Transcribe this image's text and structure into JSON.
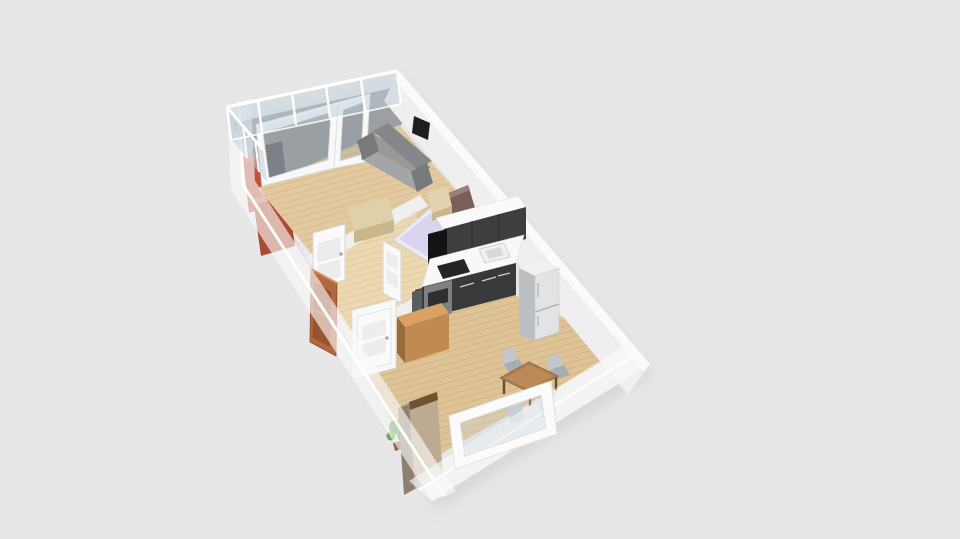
{
  "scene": {
    "kind": "3d-floorplan-render",
    "rooms": [
      {
        "name": "balcony"
      },
      {
        "name": "living-room"
      },
      {
        "name": "hallway"
      },
      {
        "name": "bed-nook"
      },
      {
        "name": "kitchen"
      },
      {
        "name": "dining-area"
      }
    ],
    "objects": [
      {
        "name": "glass-railing"
      },
      {
        "name": "balcony-divider"
      },
      {
        "name": "red-cabinet"
      },
      {
        "name": "window-wall"
      },
      {
        "name": "sofa"
      },
      {
        "name": "tv"
      },
      {
        "name": "sideboard"
      },
      {
        "name": "bed"
      },
      {
        "name": "headboard"
      },
      {
        "name": "nightstand"
      },
      {
        "name": "upper-cabinets"
      },
      {
        "name": "range-hood"
      },
      {
        "name": "cooktop"
      },
      {
        "name": "counter"
      },
      {
        "name": "sink"
      },
      {
        "name": "oven"
      },
      {
        "name": "fridge"
      },
      {
        "name": "interior-door"
      },
      {
        "name": "entry-door"
      },
      {
        "name": "hall-cabinet"
      },
      {
        "name": "dining-table"
      },
      {
        "name": "chair"
      },
      {
        "name": "plant"
      },
      {
        "name": "tall-wardrobe"
      },
      {
        "name": "end-window"
      }
    ]
  },
  "colors": {
    "background": "#e7e7e7",
    "shadow": "#c8c8c8",
    "slab": "#f3f3f3",
    "wall_face": "#efefef",
    "wall_edge": "#fbfbfb",
    "ghost_wall": "rgba(250,250,250,0.62)",
    "glass_rail": "rgba(190,206,216,0.5)",
    "glass_window": "rgba(150,160,166,0.3)",
    "window_glass": "rgba(210,218,224,0.3)",
    "balcony_floor": "#9da0a2",
    "divider": "#70757a",
    "red_cabinet": "#bc5540",
    "red_cabinet_dark": "#aa4a33",
    "red_cabinet_top": "#cf705a",
    "wood_living": "#e3c9a0",
    "wood_hall": "#ecd9b2",
    "wood_dining": "#dec397",
    "p_wall": "#f2f2f2",
    "frame_white": "#f7f8f8",
    "sofa_back": "#85878a",
    "sofa_seat": "#97999b",
    "sofa_front": "#a3a5a7",
    "sofa_arm": "#77797b",
    "tv": "#1e1e20",
    "door_white": "#fafafa",
    "door_panel": "#ededed",
    "entry_door": "#b26743",
    "entry_panel": "#97552f",
    "sideboard": "#e0d0aa",
    "sideboard_front": "#c9b68c",
    "bed_frame": "#eceaf4",
    "bed_mattress": "#dad5ed",
    "pillow": "#f6f5fb",
    "headboard": "#7a5e5a",
    "headboard_top": "#9c7f79",
    "nightstand": "#e2d2ae",
    "cab_upper_top": "#fafafa",
    "cab_dark": "#3c3e40",
    "counter": "#f8f8f8",
    "counter_front": "#37393b",
    "hood": "#141416",
    "cooktop": "#232527",
    "oven": "#7e8183",
    "oven_window": "#2d2f31",
    "end_side": "#5a5d60",
    "sink_rim": "#f0f0f0",
    "sink_basin": "#d7d9da",
    "fridge_top": "#eef0f1",
    "fridge_side": "#bcbfc1",
    "fridge_front": "#e1e3e4",
    "hall_cab_top": "#d9a263",
    "hall_cab_front": "#c08a50",
    "hall_cab_side": "#9a6b3a",
    "table_top": "#b07e4e",
    "table_light": "#bf8d5c",
    "table_leg": "#6e4d2e",
    "chair_seat": "#a6adb3",
    "chair_back": "#c2c8cd",
    "wardrobe_front": "#bcab92",
    "wardrobe_side": "#8d8071",
    "wardrobe_trim": "#6d5234",
    "wardrobe_top": "#c7b697",
    "plant_dark": "#4c7c38",
    "plant_mid": "#5f9348",
    "plant_light": "#71a156",
    "pot": "#8a6a4a"
  }
}
